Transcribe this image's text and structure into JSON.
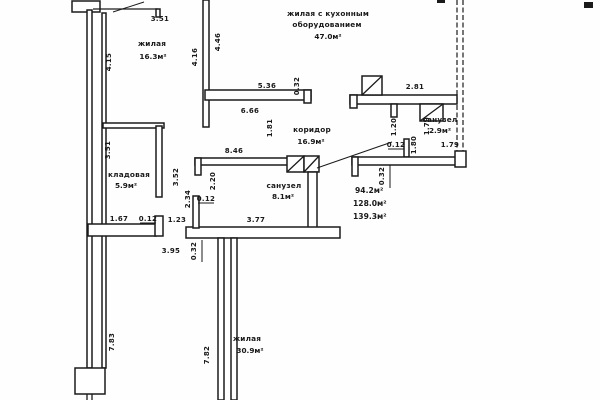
{
  "drawing": {
    "type": "apartment floor plan (scanned technical drawing)",
    "line_color": "#1b1b1b",
    "paper_color": "#fefefe"
  },
  "rooms": {
    "living_top": {
      "name": "жилая",
      "area": "16.3м²"
    },
    "living_kitchen": {
      "name_line1": "жилая с кухонным",
      "name_line2": "оборудованием",
      "area": "47.0м²"
    },
    "corridor": {
      "name": "коридор",
      "area": "16.9м²"
    },
    "bathroom_small": {
      "name": "санузел",
      "area": "2.9м²"
    },
    "bathroom_large": {
      "name": "санузел",
      "area": "8.1м²"
    },
    "storage": {
      "name": "кладовая",
      "area": "5.9м²"
    },
    "living_bottom": {
      "name": "жилая",
      "area": "30.9м²"
    }
  },
  "area_summary": {
    "line1": "94.2м²",
    "line2": "128.0м²",
    "line3": "139.3м²"
  },
  "dims": {
    "d351_top": "3.51",
    "d415": "4.15",
    "d416": "4.16",
    "d446": "4.46",
    "d536": "5.36",
    "d032_top": "0.32",
    "d666": "6.66",
    "d281": "2.81",
    "d181": "1.81",
    "d120": "1.20",
    "d179_v": "1.79",
    "d012_bath_small": "0.12",
    "d180": "1.80",
    "d179_h": "1.79",
    "d846": "8.46",
    "d220": "2.20",
    "d234": "2.34",
    "d012_bath_large": "0.12",
    "d377": "3.77",
    "d351_left": "3.51",
    "d352": "3.52",
    "d167": "1.67",
    "d012_storage": "0.12",
    "d123": "1.23",
    "d395": "3.95",
    "d032_bottom_left": "0.32",
    "d032_bottom_right": "0.32",
    "d783": "7.83",
    "d782": "7.82"
  }
}
